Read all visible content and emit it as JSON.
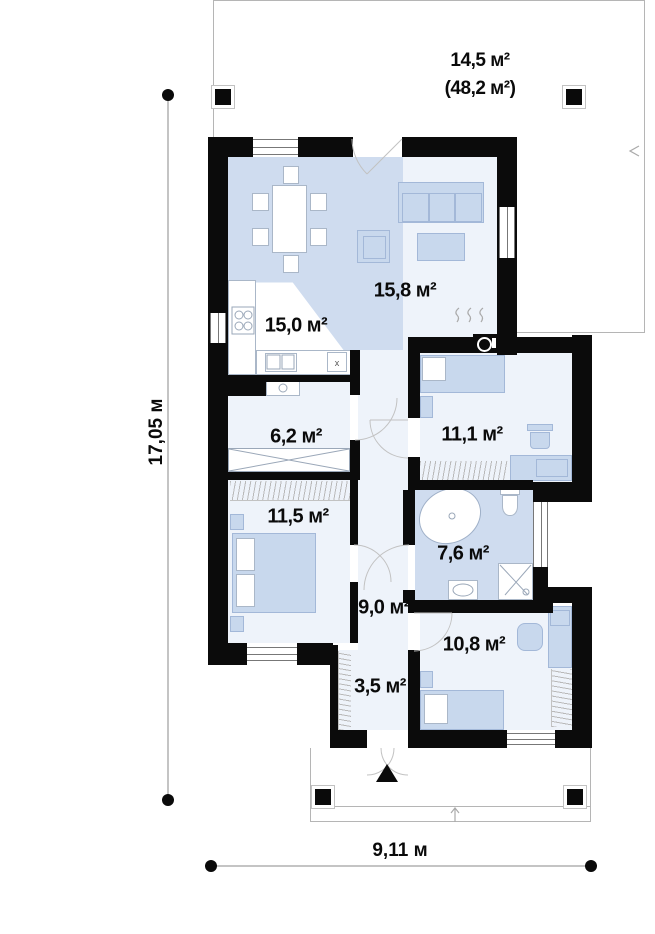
{
  "plan": {
    "terrace": {
      "area": "14,5 м²",
      "total_area": "(48,2 м²)"
    },
    "rooms": [
      {
        "id": "kitchen-dining",
        "area": "15,0 м²"
      },
      {
        "id": "living-room",
        "area": "15,8 м²"
      },
      {
        "id": "hallway",
        "area": "6,2 м²"
      },
      {
        "id": "bedroom-1",
        "area": "11,1 м²"
      },
      {
        "id": "bedroom-2",
        "area": "11,5 м²"
      },
      {
        "id": "bathroom",
        "area": "7,6 м²"
      },
      {
        "id": "corridor",
        "area": "9,0 м²"
      },
      {
        "id": "bedroom-3",
        "area": "10,8 м²"
      },
      {
        "id": "entrance-hall",
        "area": "3,5 м²"
      }
    ],
    "dimensions": {
      "height": "17,05 м",
      "width": "9,11 м"
    },
    "vent_label": "x",
    "colors": {
      "wall": "#0b0b0b",
      "floor_blue": "#cfdcef",
      "floor_pale": "#eef3fa",
      "furniture": "#c8d8ed",
      "line_gray": "#b5b5b5"
    }
  }
}
